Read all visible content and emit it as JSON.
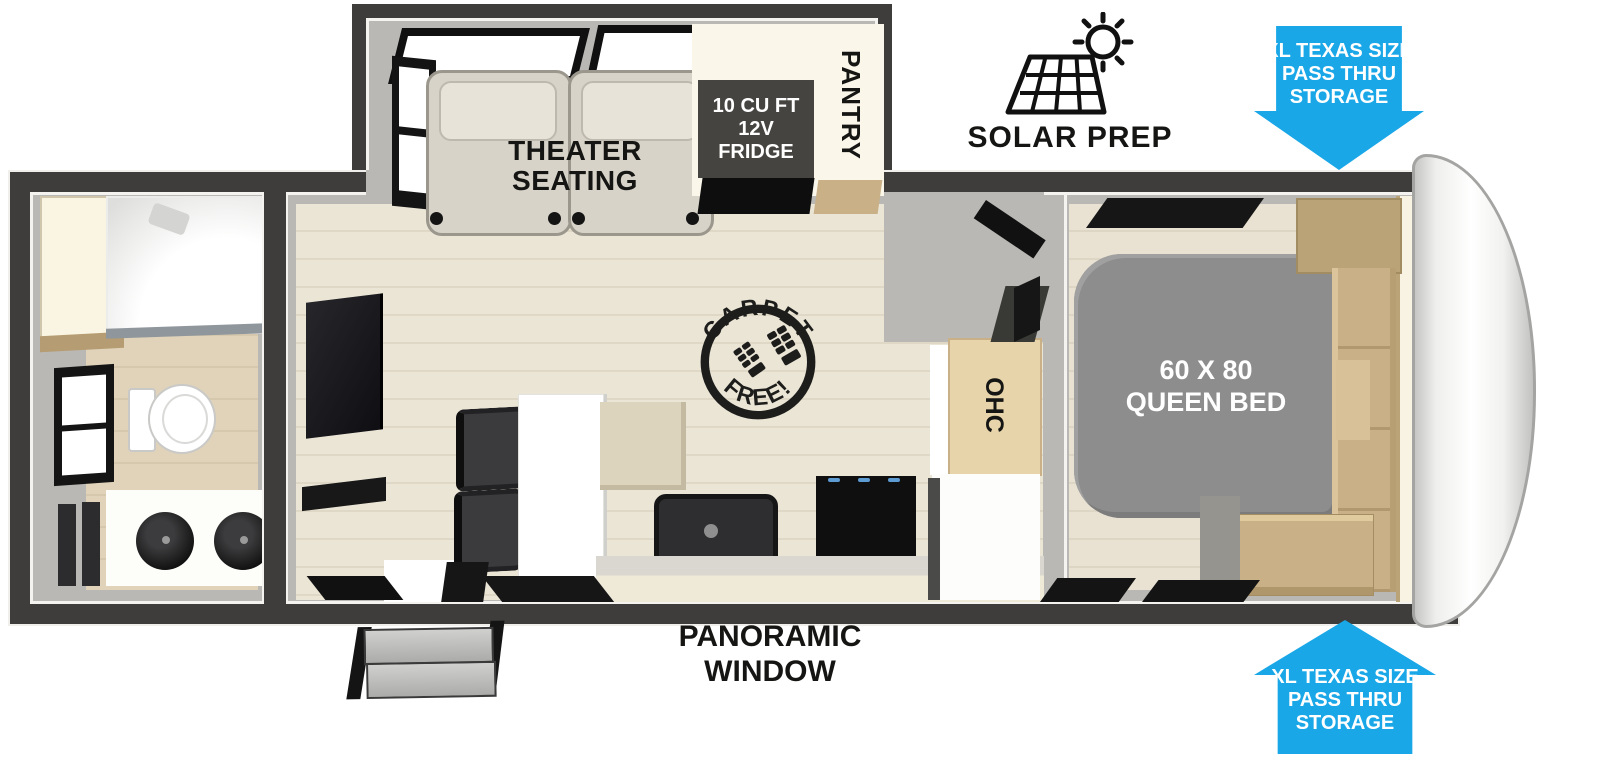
{
  "labels": {
    "theater_seating": "THEATER\nSEATING",
    "fridge": "10 CU FT\n12V\nFRIDGE",
    "pantry": "PANTRY",
    "solar_prep": "SOLAR PREP",
    "storage_arrow_top": "XL TEXAS SIZE\nPASS THRU\nSTORAGE",
    "storage_arrow_bottom": "XL TEXAS SIZE\nPASS THRU\nSTORAGE",
    "carpet_stamp_top": "CARPET",
    "carpet_stamp_bottom": "FREE!",
    "ohc_kitchen": "OHC",
    "ohc_bedroom": "OHC",
    "queen_bed": "60 X 80\nQUEEN BED",
    "panoramic_window": "PANORAMIC\nWINDOW"
  },
  "colors": {
    "arrow_blue": "#19a7e8",
    "wall_dark": "#3e3d3b",
    "wall_band": "#b9b8b4",
    "floor_wood": "#ebe5d6",
    "bed_gray": "#8d8d8d",
    "fridge_dark": "#454440",
    "cabinet_wood": "#c9b086",
    "cream": "#f8f3e3"
  }
}
